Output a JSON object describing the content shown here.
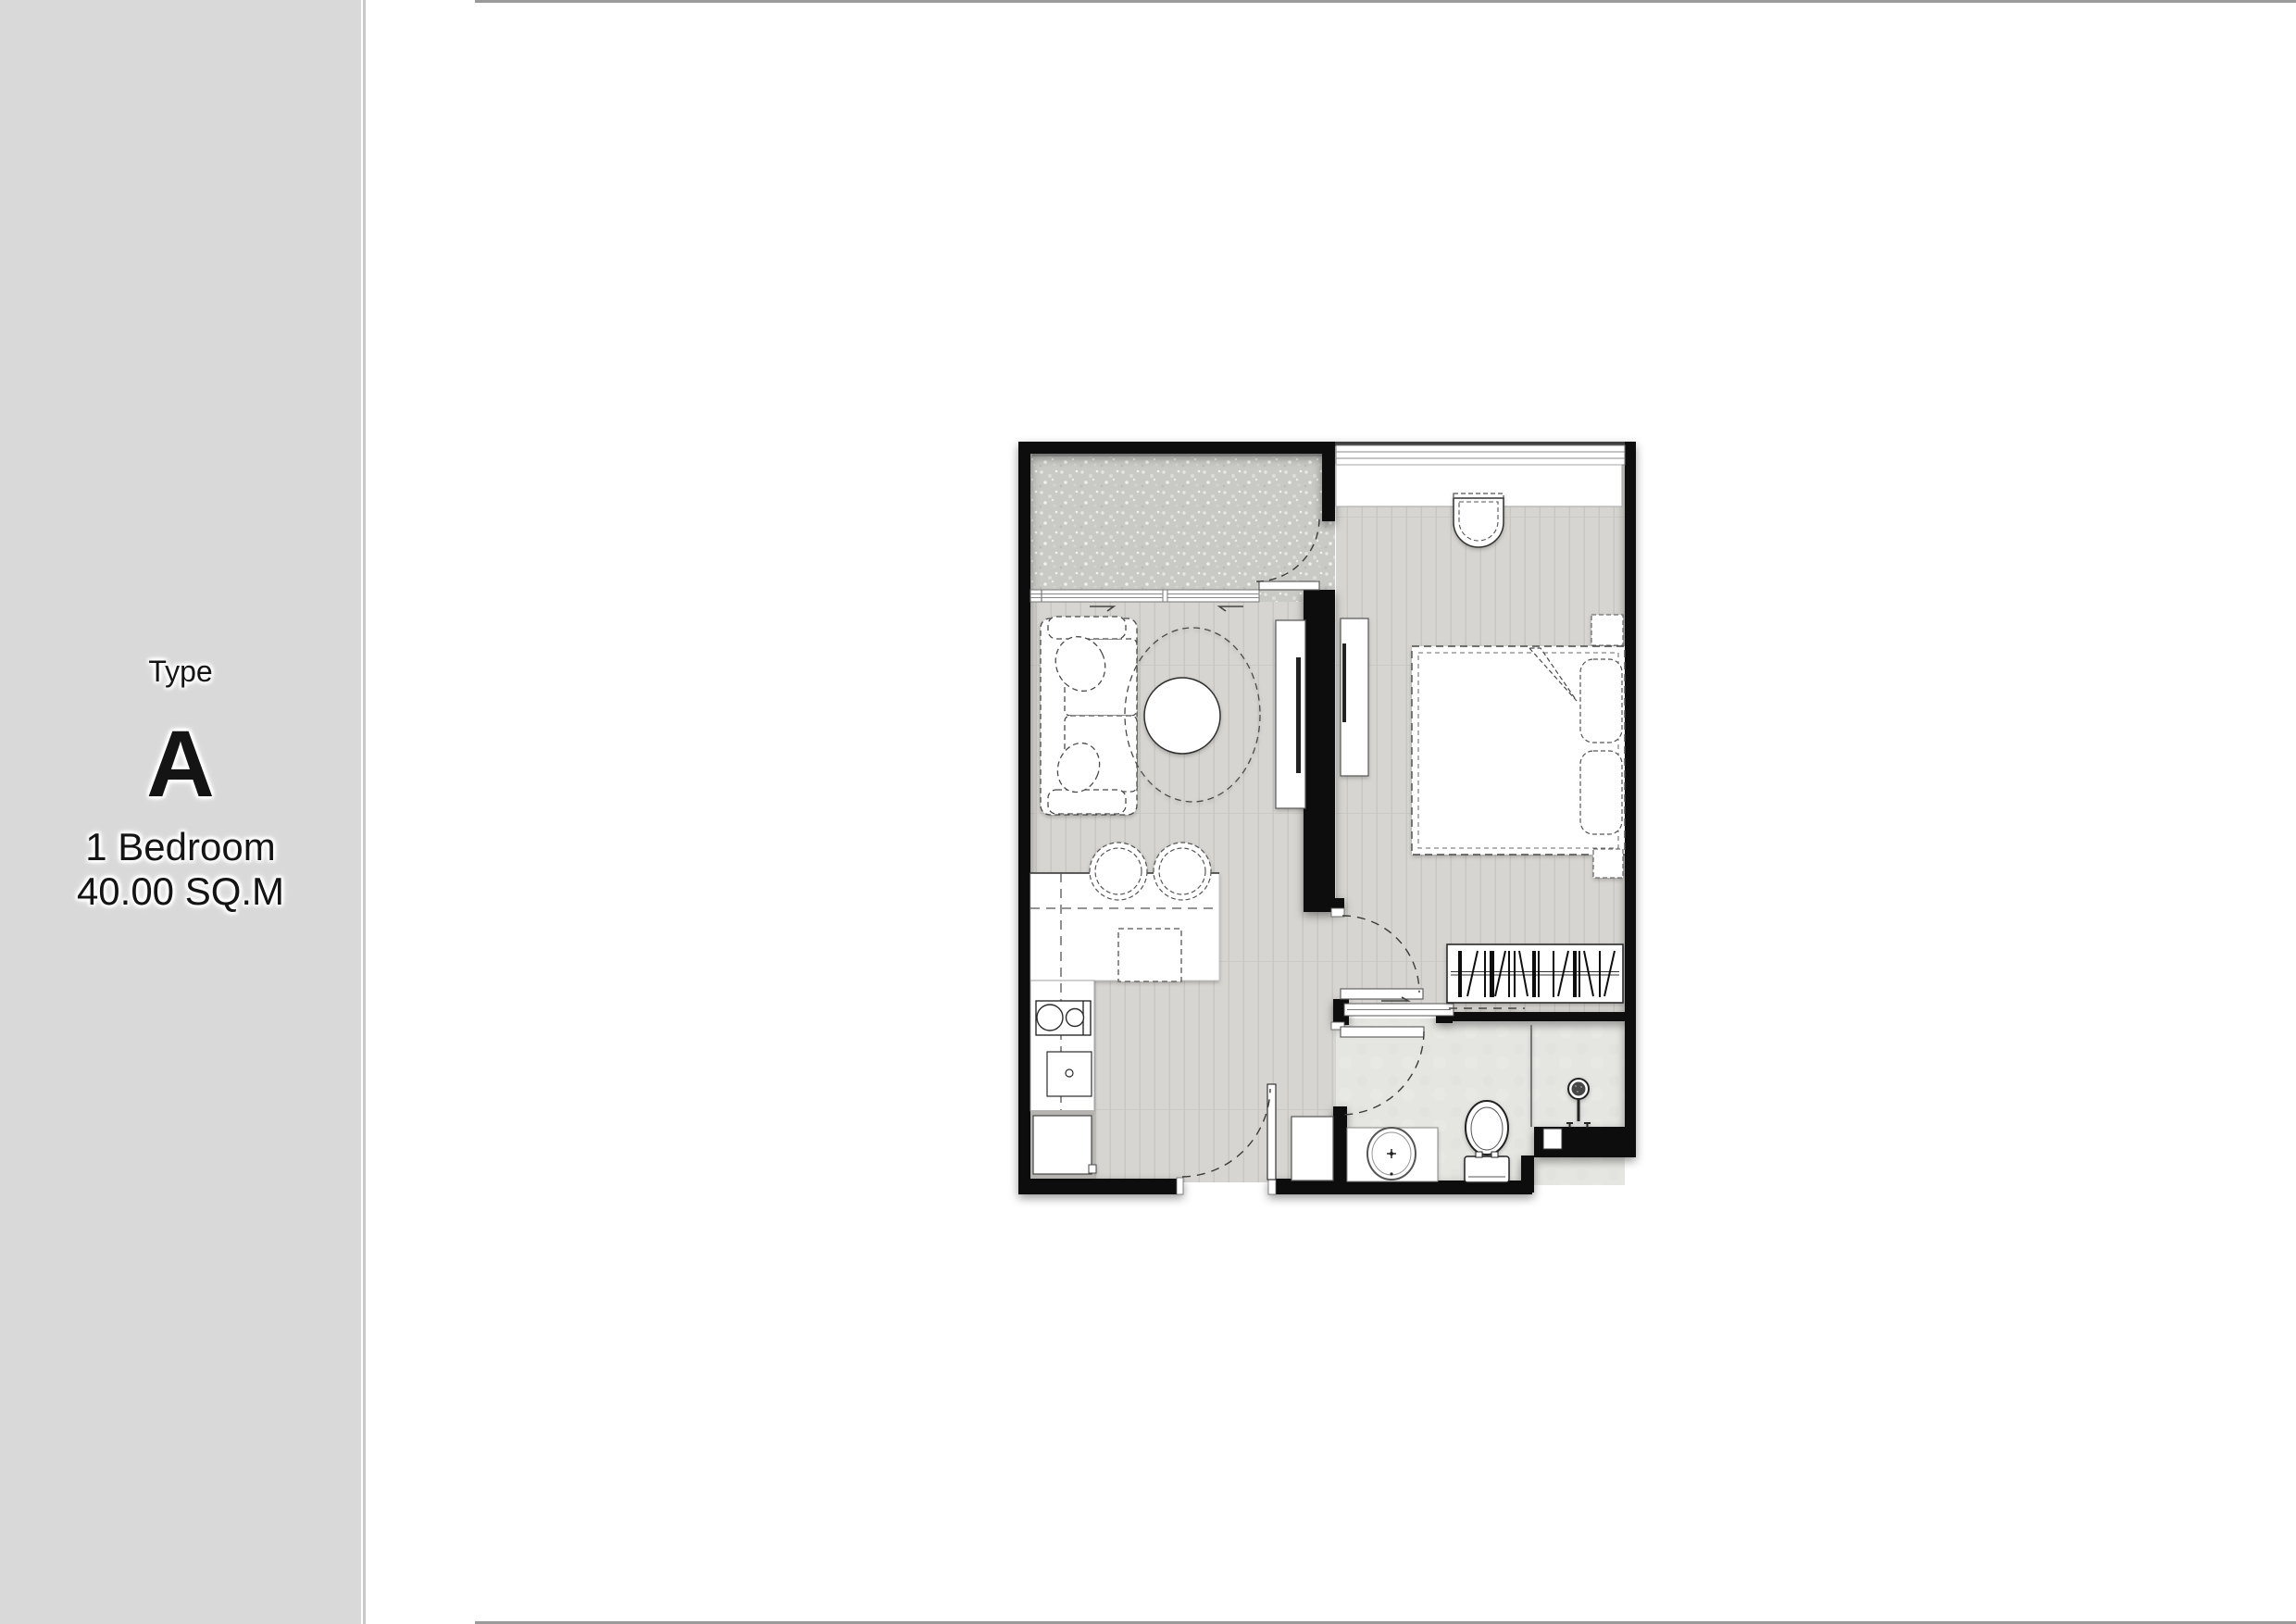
{
  "sidebar": {
    "type_label": "Type",
    "unit_letter": "A",
    "bedroom_label": "1 Bedroom",
    "area_label": "40.00 SQ.M",
    "background": "#d9d9d9"
  },
  "rules": {
    "color": "#9a9a9a"
  },
  "floorplan": {
    "wall_color": "#0e0e0e",
    "wood_floor_color": "#d6d5d1",
    "balcony_floor_color": "#c9c9c6",
    "bathroom_floor_color": "#e5e5e2",
    "rooms": [
      "balcony",
      "living-dining",
      "kitchen",
      "corridor",
      "bedroom",
      "bathroom"
    ],
    "fixtures": [
      "sofa",
      "throw-pillows",
      "coffee-table",
      "rug",
      "tv-console",
      "tv",
      "bedroom-tv-cabinet",
      "dining-table",
      "dining-chairs",
      "kitchen-counter",
      "stove",
      "kitchen-sink",
      "refrigerator",
      "entrance-door",
      "balcony-door",
      "sliding-windows",
      "bedroom-door",
      "bathroom-door",
      "sliding-track",
      "wardrobe",
      "bed",
      "pillows",
      "nightstands",
      "desk-chair",
      "window-bench",
      "shoe-cabinet",
      "vanity-sink",
      "toilet",
      "shower-head",
      "shower-partition"
    ]
  }
}
